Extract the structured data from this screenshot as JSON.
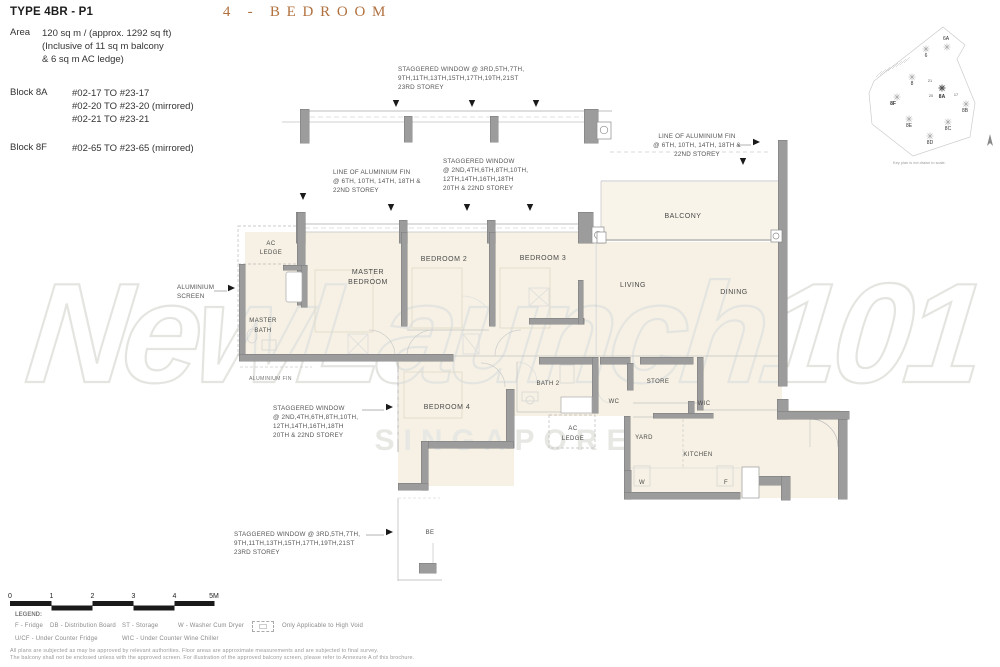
{
  "colors": {
    "heading": "#b1713f",
    "wall": "#9c9c9c",
    "floor": "#f6f1e4",
    "watermark_stroke": "#e4e4e0"
  },
  "header": {
    "type_title": "TYPE 4BR - P1",
    "area_label": "Area",
    "area_lines": [
      "120 sq m / (approx. 1292 sq ft)",
      "(Inclusive of 11 sq m balcony",
      "& 6 sq m AC ledge)"
    ],
    "block_8a_label": "Block 8A",
    "block_8a_units": [
      "#02-17 TO #23-17",
      "#02-20 TO #23-20 (mirrored)",
      "#02-21 TO #23-21"
    ],
    "block_8f_label": "Block 8F",
    "block_8f_units": [
      "#02-65 TO #23-65 (mirrored)"
    ],
    "heading": "4 - BEDROOM"
  },
  "keyplan": {
    "blocks": [
      "6A",
      "6",
      "8",
      "8F",
      "8A",
      "8B",
      "8E",
      "8C",
      "8D"
    ],
    "unit_numbers": [
      "21",
      "20",
      "17"
    ],
    "caption": "Key plan is not drawn to scale."
  },
  "plan": {
    "rooms": {
      "ac_ledge_top": [
        "AC",
        "LEDGE"
      ],
      "master_bath": [
        "MASTER",
        "BATH"
      ],
      "master_bedroom": [
        "MASTER",
        "BEDROOM"
      ],
      "bedroom2": "BEDROOM 2",
      "bedroom3": "BEDROOM 3",
      "balcony": "BALCONY",
      "living": "LIVING",
      "dining": "DINING",
      "bath2": "BATH 2",
      "bedroom4": "BEDROOM 4",
      "store": "STORE",
      "wc": "WC",
      "wic": "WIC",
      "ac_ledge_bottom": [
        "AC",
        "LEDGE"
      ],
      "yard": "YARD",
      "kitchen": "KITCHEN",
      "washer": "W",
      "fridge": "F",
      "below_unit": "BE"
    },
    "annotations": {
      "staggered_top": [
        "STAGGERED WINDOW @ 3RD,5TH,7TH,",
        "9TH,11TH,13TH,15TH,17TH,19TH,21ST",
        "23RD STOREY"
      ],
      "fin_left": [
        "LINE OF ALUMINIUM FIN",
        "@  6TH, 10TH, 14TH, 18TH &",
        "22ND STOREY"
      ],
      "staggered_mid": [
        "STAGGERED WINDOW",
        "@ 2ND,4TH,6TH,8TH,10TH,",
        "12TH,14TH,16TH,18TH",
        "20TH & 22ND STOREY"
      ],
      "fin_right": [
        "LINE OF ALUMINIUM FIN",
        "@  6TH, 10TH, 14TH, 18TH &",
        "22ND STOREY"
      ],
      "staggered_bed4": [
        "STAGGERED WINDOW",
        "@ 2ND,4TH,6TH,8TH,10TH,",
        "12TH,14TH,16TH,18TH",
        "20TH & 22ND STOREY"
      ],
      "staggered_bottom": [
        "STAGGERED WINDOW @ 3RD,5TH,7TH,",
        "9TH,11TH,13TH,15TH,17TH,19TH,21ST",
        "23RD STOREY"
      ],
      "alum_screen": [
        "ALUMINIUM",
        "SCREEN"
      ],
      "alum_fin": "ALUMINIUM FIN"
    }
  },
  "watermark": {
    "brand": "NewLaunch101",
    "subtitle": "SINGAPORE"
  },
  "footer": {
    "scale_ticks": [
      "0",
      "1",
      "2",
      "3",
      "4",
      "5M"
    ],
    "legend_title": "LEGEND:",
    "legend_row1": [
      "F - Fridge",
      "DB - Distribution Board",
      "ST - Storage",
      "W - Washer Cum Dryer"
    ],
    "legend_highvoid": "Only Applicable to High Void",
    "legend_row2": [
      "U/CF - Under Counter Fridge",
      "WIC - Under Counter Wine Chiller"
    ],
    "disclaimer1": "All plans are subjected as may be approved by relevant authorities. Floor areas are approximate measurements and are subjected to final survey.",
    "disclaimer2": "The balcony shall not be enclosed unless with the approved screen. For illustration of the approved balcony screen, please refer to Annexure A of this brochure."
  }
}
